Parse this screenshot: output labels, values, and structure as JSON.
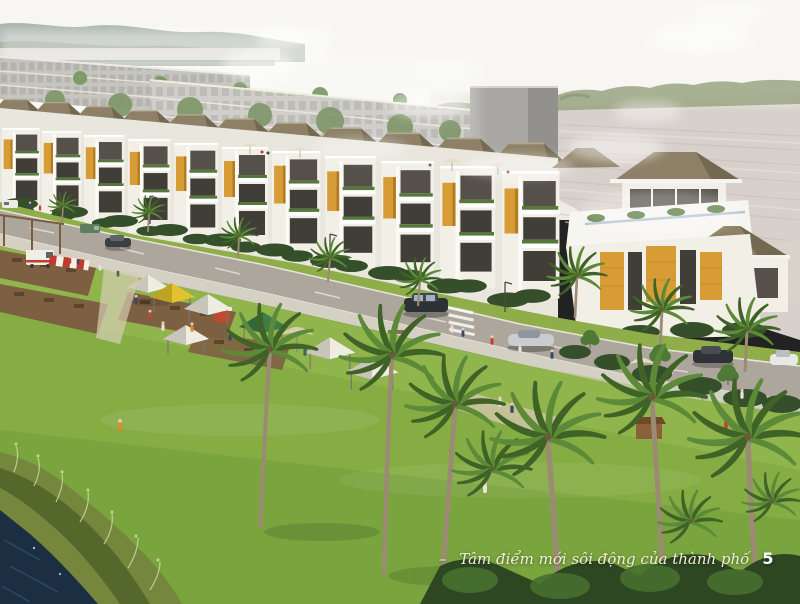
{
  "page": {
    "caption_dash": "–",
    "caption": "Tâm điểm mới sôi động của thành phố",
    "page_number": "5"
  },
  "scene": {
    "colors": {
      "sky_top": "#f7f6f2",
      "sky_low": "#e9e6df",
      "mountain_far": "#8e9c94",
      "mountain_near": "#85927c",
      "field": "#d8d0cb",
      "field_line": "#c2b9b4",
      "field_light": "#eae3de",
      "treeline": "#9aa583",
      "building_grey": "#b4b2ab",
      "building_grey2": "#c2c0b9",
      "box_grey": "#a9a7a3",
      "box_grey_dark": "#93918d",
      "roof": "#8d8066",
      "roof_dark": "#746950",
      "fascia": "#f6f4ee",
      "facade": "#f2efe7",
      "facade_shade": "#e9e6dd",
      "amber": "#d79c35",
      "amber_dark": "#b07c1f",
      "glass": "#55514a",
      "glass_dark": "#413e38",
      "planter": "#57783b",
      "hedge": "#344f2a",
      "tree_green": "#4e7a35",
      "verge": "#8fae49",
      "street": "#aca69c",
      "sidewalk": "#d4d0c3",
      "lawn": "#86ad44",
      "lawn_light": "#9fbe58",
      "lawn_dark": "#6d9c38",
      "deck": "#7d5f41",
      "deck_dark": "#5c4529",
      "tent_white": "#efece1",
      "tent_yellow": "#e3c32d",
      "tent_green": "#3f7c48",
      "tent_red": "#bf4a2e",
      "awning_red": "#c03a2e",
      "stall_wood": "#8a6138",
      "umbrella_cream": "#e6dcc1",
      "palm_dark": "#3f6327",
      "palm_light": "#5c8a38",
      "trunk": "#9b8b73",
      "water": "#1c2f42",
      "water_light": "#3d5e78",
      "reed": "#75863d",
      "reed_light": "#cdd9a0",
      "skin": "#e9cdb2",
      "caption_color": "#f2ecd9",
      "page_number_color": "#ffffff"
    }
  }
}
